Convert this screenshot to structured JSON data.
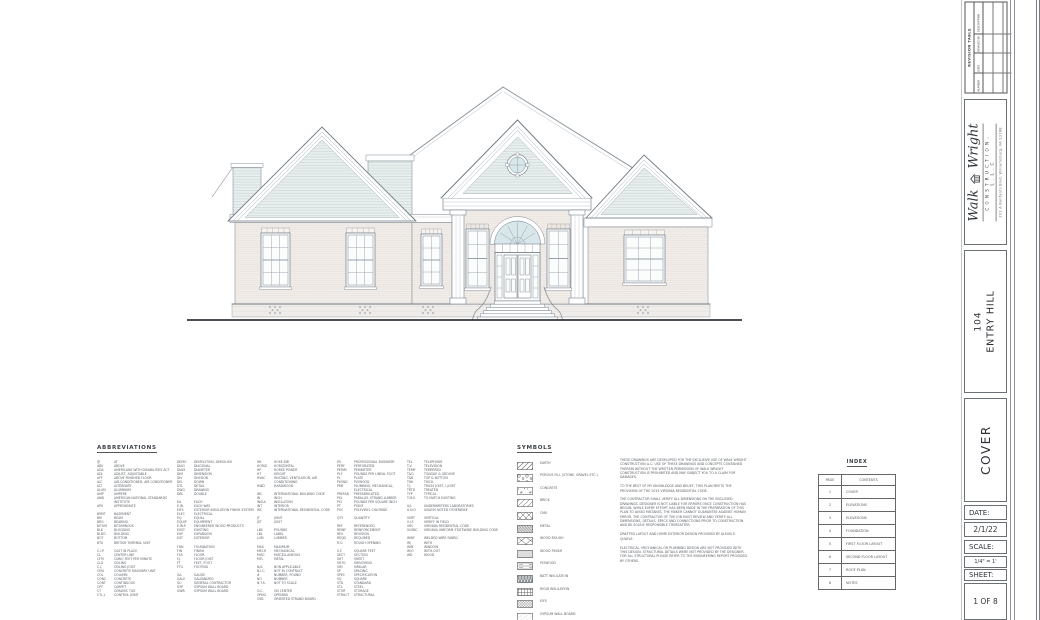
{
  "sheet": {
    "project_number": "104",
    "project_name": "ENTRY HILL",
    "sheet_title": "COVER",
    "date_label": "DATE:",
    "date_value": "2/1/22",
    "scale_label": "SCALE:",
    "scale_value": "1/4\" = 1'",
    "sheet_label": "SHEET:",
    "sheet_value": "1 OF 8"
  },
  "logo": {
    "word1": "Walk",
    "word2": "Wright",
    "subtitle": "CONSTRUCTION, L.L.C",
    "address": "201 A Bulifants Blvd, Williamsburg, VA 23188"
  },
  "revision_table": {
    "title": "REVISION TABLE",
    "columns": [
      "NUMBER",
      "DATE",
      "REVISED BY",
      "DESCRIPTION"
    ],
    "empty_rows": 3
  },
  "abbreviations": {
    "title": "ABBREVIATIONS",
    "columns": [
      [
        {
          "a": "@",
          "d": "AT"
        },
        {
          "a": "ABV",
          "d": "ABOVE"
        },
        {
          "a": "ADA",
          "d": "AMERICANS WITH DISABILITIES ACT"
        },
        {
          "a": "ADJ",
          "d": "ADJUST, ADJUSTABLE"
        },
        {
          "a": "AFF",
          "d": "ABOVE FINISHED FLOOR"
        },
        {
          "a": "A/C",
          "d": "AIR-CONDITIONED, AIR CONDITIONER"
        },
        {
          "a": "ALT",
          "d": "ALTERNATE"
        },
        {
          "a": "ALUM",
          "d": "ALUMINUM"
        },
        {
          "a": "AMP",
          "d": "AMPERE"
        },
        {
          "a": "ANSI",
          "d": "AMERICAN NATIONAL STANDARDS INSTITUTE"
        },
        {
          "a": "APX",
          "d": "APPROXIMATE"
        },
        {
          "a": "",
          "d": ""
        },
        {
          "a": "BSMT",
          "d": "BASEMENT"
        },
        {
          "a": "BM",
          "d": "BEAM"
        },
        {
          "a": "BRG",
          "d": "BEARING"
        },
        {
          "a": "BITUM",
          "d": "BITUMINOUS"
        },
        {
          "a": "BLK",
          "d": "BLOCKING"
        },
        {
          "a": "BLDG",
          "d": "BUILDING"
        },
        {
          "a": "BOT",
          "d": "BOTTOM"
        },
        {
          "a": "BTU",
          "d": "BRITISH THERMAL UNIT"
        },
        {
          "a": "",
          "d": ""
        },
        {
          "a": "C.I.P.",
          "d": "CAST IN PLACE"
        },
        {
          "a": "CL",
          "d": "CENTER LINE"
        },
        {
          "a": "CFM",
          "d": "CUBIC FEET PER MINUTE"
        },
        {
          "a": "CLG",
          "d": "CEILING"
        },
        {
          "a": "C.J.",
          "d": "CEILING JOIST"
        },
        {
          "a": "CMU",
          "d": "CONCRETE MASONRY UNIT"
        },
        {
          "a": "COL",
          "d": "COLUMN"
        },
        {
          "a": "CONC",
          "d": "CONCRETE"
        },
        {
          "a": "CONT",
          "d": "CONTINUOUS"
        },
        {
          "a": "CPT",
          "d": "CARPET"
        },
        {
          "a": "CT",
          "d": "CERAMIC TILE"
        },
        {
          "a": "CTL.J.",
          "d": "CONTROL JOINT"
        }
      ],
      [
        {
          "a": "DEMO",
          "d": "DEMOLITION, DEMOLISH"
        },
        {
          "a": "DIAG",
          "d": "DIAGONAL"
        },
        {
          "a": "DIAM",
          "d": "DIAMETER"
        },
        {
          "a": "DIM",
          "d": "DIMENSION"
        },
        {
          "a": "DIV",
          "d": "DIVISION"
        },
        {
          "a": "DN",
          "d": "DOWN"
        },
        {
          "a": "DTL",
          "d": "DETAIL"
        },
        {
          "a": "DWG",
          "d": "DRAWING"
        },
        {
          "a": "DBL",
          "d": "DOUBLE"
        },
        {
          "a": "",
          "d": ""
        },
        {
          "a": "EA",
          "d": "EACH"
        },
        {
          "a": "E.W.",
          "d": "EACH WAY"
        },
        {
          "a": "EIFS",
          "d": "EXTERIOR INSULATION FINISH SYSTEM"
        },
        {
          "a": "ELEC",
          "d": "ELECTRICAL"
        },
        {
          "a": "EQ",
          "d": "EQUAL"
        },
        {
          "a": "EQUIP",
          "d": "EQUIPMENT"
        },
        {
          "a": "E.W.P.",
          "d": "ENGINEERED WOOD PRODUCTS"
        },
        {
          "a": "EXST",
          "d": "EXISTING"
        },
        {
          "a": "EXP",
          "d": "EXPANSION"
        },
        {
          "a": "EXT",
          "d": "EXTERIOR"
        },
        {
          "a": "",
          "d": ""
        },
        {
          "a": "FDN",
          "d": "FOUNDATION"
        },
        {
          "a": "FIN",
          "d": "FINISH"
        },
        {
          "a": "FLR",
          "d": "FLOOR"
        },
        {
          "a": "F.J.",
          "d": "FLOOR JOIST"
        },
        {
          "a": "FT",
          "d": "FEET, FOOT"
        },
        {
          "a": "FTG",
          "d": "FOOTING"
        },
        {
          "a": "",
          "d": ""
        },
        {
          "a": "GA",
          "d": "GAUGE"
        },
        {
          "a": "GALV",
          "d": "GALVANIZED"
        },
        {
          "a": "GC",
          "d": "GENERAL CONTRACTOR"
        },
        {
          "a": "GYP",
          "d": "GYPSUM WALL BOARD"
        },
        {
          "a": "GWB",
          "d": "GYPSUM WALL BOARD"
        }
      ],
      [
        {
          "a": "HB",
          "d": "HOSE BIB"
        },
        {
          "a": "HORIZ",
          "d": "HORIZONTAL"
        },
        {
          "a": "HP",
          "d": "HORSE POWER"
        },
        {
          "a": "HT",
          "d": "HEIGHT"
        },
        {
          "a": "HVAC",
          "d": "HEATING, VENTILATION, AIR CONDITIONING"
        },
        {
          "a": "HWD",
          "d": "HARDWOOD"
        },
        {
          "a": "",
          "d": ""
        },
        {
          "a": "IBC",
          "d": "INTERNATIONAL BUILDING CODE"
        },
        {
          "a": "IN",
          "d": "INCH"
        },
        {
          "a": "INSUL",
          "d": "INSULATION"
        },
        {
          "a": "INT",
          "d": "INTERIOR"
        },
        {
          "a": "IRC",
          "d": "INTERNATIONAL RESIDENTIAL CODE"
        },
        {
          "a": "",
          "d": ""
        },
        {
          "a": "JT",
          "d": "JOINT"
        },
        {
          "a": "JST",
          "d": "JOIST"
        },
        {
          "a": "",
          "d": ""
        },
        {
          "a": "LBS",
          "d": "POUNDS"
        },
        {
          "a": "LBL",
          "d": "LABEL"
        },
        {
          "a": "LUM",
          "d": "LUMBER"
        },
        {
          "a": "",
          "d": ""
        },
        {
          "a": "MAX",
          "d": "MAXIMUM"
        },
        {
          "a": "MECH",
          "d": "MECHANICAL"
        },
        {
          "a": "MISC",
          "d": "MISCELLANEOUS"
        },
        {
          "a": "MTL",
          "d": "METAL"
        },
        {
          "a": "",
          "d": ""
        },
        {
          "a": "N/A",
          "d": "NON APPLICABLE"
        },
        {
          "a": "N.I.C.",
          "d": "NOT IN CONTRACT"
        },
        {
          "a": "#",
          "d": "NUMBER, POUND"
        },
        {
          "a": "NO",
          "d": "NUMBER"
        },
        {
          "a": "N.T.S.",
          "d": "NOT TO SCALE"
        },
        {
          "a": "",
          "d": ""
        },
        {
          "a": "O.C.",
          "d": "ON CENTER"
        },
        {
          "a": "OPNG",
          "d": "OPENING"
        },
        {
          "a": "OSB",
          "d": "ORIENTED STRAND BOARD"
        }
      ],
      [
        {
          "a": "P.E.",
          "d": "PROFESSIONAL ENGINEER"
        },
        {
          "a": "PERF",
          "d": "PERFORATED"
        },
        {
          "a": "PERIM",
          "d": "PERIMETER"
        },
        {
          "a": "PLF",
          "d": "POUNDS PER LINEAL FOOT"
        },
        {
          "a": "PL",
          "d": "PLATE"
        },
        {
          "a": "PLYWD",
          "d": "PLYWOOD"
        },
        {
          "a": "PME",
          "d": "PLUMBING, MECHANICAL, ELECTRICAL"
        },
        {
          "a": "PREFAB",
          "d": "PREFABRICATED"
        },
        {
          "a": "PSL",
          "d": "PARALLEL STRAND LUMBER"
        },
        {
          "a": "PSI",
          "d": "POUNDS PER SQUARE INCH"
        },
        {
          "a": "PT",
          "d": "POINT"
        },
        {
          "a": "PVC",
          "d": "POLYVINYL CHLORIDE"
        },
        {
          "a": "",
          "d": ""
        },
        {
          "a": "QTY",
          "d": "QUANTITY"
        },
        {
          "a": "",
          "d": ""
        },
        {
          "a": "REF",
          "d": "REFERENCED"
        },
        {
          "a": "REINF",
          "d": "REINFORCEMENT"
        },
        {
          "a": "REV",
          "d": "REVISION"
        },
        {
          "a": "REQD",
          "d": "REQUIRED"
        },
        {
          "a": "R.O.",
          "d": "ROUGH OPENING"
        },
        {
          "a": "",
          "d": ""
        },
        {
          "a": "S.F.",
          "d": "SQUARE FEET"
        },
        {
          "a": "SECT",
          "d": "SECTION"
        },
        {
          "a": "SHT",
          "d": "SHEET"
        },
        {
          "a": "SHTG",
          "d": "SHEATHING"
        },
        {
          "a": "SIM",
          "d": "SIMILAR"
        },
        {
          "a": "SP",
          "d": "SPACING"
        },
        {
          "a": "SPEC",
          "d": "SPECIFICATION"
        },
        {
          "a": "SQ",
          "d": "SQUARE"
        },
        {
          "a": "STD",
          "d": "STANDARD"
        },
        {
          "a": "STL",
          "d": "STEEL"
        },
        {
          "a": "STOR",
          "d": "STORAGE"
        },
        {
          "a": "STRUCT",
          "d": "STRUCTURAL"
        }
      ],
      [
        {
          "a": "TEL",
          "d": "TELEPHONE"
        },
        {
          "a": "T.V.",
          "d": "TELEVISION"
        },
        {
          "a": "TEMP",
          "d": "TEMPERED"
        },
        {
          "a": "T&G",
          "d": "TONGUE & GROOVE"
        },
        {
          "a": "T&B",
          "d": "TOP & BOTTOM"
        },
        {
          "a": "THK",
          "d": "THICK"
        },
        {
          "a": "T.J.",
          "d": "TRUSS JOIST, I-JOIST"
        },
        {
          "a": "TRTD",
          "d": "TREATED"
        },
        {
          "a": "TYP",
          "d": "TYPICAL"
        },
        {
          "a": "T.M.E.",
          "d": "TO MATCH EXISTING"
        },
        {
          "a": "",
          "d": ""
        },
        {
          "a": "U/L",
          "d": "UNDERWRITERS LABORATORIES"
        },
        {
          "a": "U.N.O",
          "d": "UNLESS NOTED OTHERWISE"
        },
        {
          "a": "",
          "d": ""
        },
        {
          "a": "VERT",
          "d": "VERTICAL"
        },
        {
          "a": "V.I.F.",
          "d": "VERIFY IN FIELD"
        },
        {
          "a": "VRC",
          "d": "VIRGINIA RESIDENTIAL CODE"
        },
        {
          "a": "VUSBC",
          "d": "VIRGINIA UNIFORM STATEWIDE BUILDING CODE"
        },
        {
          "a": "",
          "d": ""
        },
        {
          "a": "WWF",
          "d": "WELDED WIRE FABRIC"
        },
        {
          "a": "W/",
          "d": "WITH"
        },
        {
          "a": "WIN",
          "d": "WINDOW"
        },
        {
          "a": "W/O",
          "d": "WITH-OUT"
        },
        {
          "a": "WD",
          "d": "WOOD"
        }
      ]
    ]
  },
  "symbols": {
    "title": "SYMBOLS",
    "items": [
      {
        "label": "EARTH",
        "pattern": "earth"
      },
      {
        "label": "POROUS FILL (STONE, GRAVEL ETC.)",
        "pattern": "porous"
      },
      {
        "label": "CONCRETE",
        "pattern": "concrete"
      },
      {
        "label": "BRICK",
        "pattern": "brick"
      },
      {
        "label": "CMU",
        "pattern": "cmu"
      },
      {
        "label": "METAL",
        "pattern": "metal"
      },
      {
        "label": "WOOD ROUGH",
        "pattern": "woodrough"
      },
      {
        "label": "WOOD FINISH",
        "pattern": "woodfinish"
      },
      {
        "label": "PLYWOOD",
        "pattern": "plywood"
      },
      {
        "label": "BATT INSULATION",
        "pattern": "batt"
      },
      {
        "label": "RIGID INSULATION",
        "pattern": "rigid"
      },
      {
        "label": "EIFS",
        "pattern": "eifs"
      },
      {
        "label": "GYPSUM WALL BOARD",
        "pattern": "gypsum"
      }
    ]
  },
  "notes": {
    "paragraphs": [
      "THESE DRAWINGS ARE DEVELOPED FOR THE EXCLUSIVE USE OF WALK WRIGHT CONSTRUCTION LLC.  USE OF THESE DRAWINGS AND CONCEPTS CONTAINED THEREIN WITHOUT THE WRITTEN PERMISSION OF WALK WRIGHT CONSTRUCTION IS PROHIBITED AND MAY SUBJECT YOU TO A CLAIM FOR DAMAGES.",
      "TO THE BEST OF MY KNOWLEDGE AND BELIEF, THIS PLAN MEETS THE PROVISION OF THE 2015 VIRGINIA RESIDENTIAL CODE.",
      "THE CONTRACTOR SHALL VERIFY ALL DIMENSIONS ON THE ENCLOSED DRAWINGS.  DESIGNER IS NOT LIABLE FOR ERRORS ONCE CONSTRUCTION HAS BEGUN.  WHILE EVERY EFFORT HAS BEEN MADE IN THE PREPARATION OF THIS PLAN TO AVOID MISTAKES, THE MAKER CANNOT GUARANTEE AGAINST HUMAN ERROR.  THE CONTRACTOR OF THE JOB MUST REVIEW AND VERIFY ALL DIMENSIONS, DETAILS, SPECS AND CONNECTIONS PRIOR TO CONSTRUCTION AND BE SOLELY RESPONSIBLE THEREAFTER.",
      "DRAFTED LAYOUT AND HOME EXTERIOR DESIGN PROVIDED BY ALEXIS E. QUAYLE.",
      "ELECTRICAL, MECHANICAL OR PLUMBING DESIGN ARE NOT PROVIDED WITH THIS DESIGN.  STRUCTURAL DETAILS WERE NOT PROVIDED BY THE DESIGNER.  FOR ALL STRUCTURAL PLEASE REFER TO THE ENGINEERING REPORT PROVIDED BY OTHERS."
    ]
  },
  "index": {
    "title": "INDEX",
    "headers": [
      "PAGE",
      "CONTENTS"
    ],
    "rows": [
      [
        "1",
        "COVER"
      ],
      [
        "2",
        "ELEVATIONS"
      ],
      [
        "3",
        "ELEVATIONS"
      ],
      [
        "4",
        "FOUNDATION"
      ],
      [
        "5",
        "FIRST FLOOR LAYOUT"
      ],
      [
        "6",
        "SECOND FLOOR LAYOUT"
      ],
      [
        "7",
        "ROOF PLAN"
      ],
      [
        "8",
        "NOTES"
      ]
    ]
  },
  "colors": {
    "line": "#8b959d",
    "brick_fill": "#f2eeeb",
    "siding_fill": "#e9efee",
    "glass_tint": "#d8e7ea",
    "ground_line": "#32373c"
  }
}
